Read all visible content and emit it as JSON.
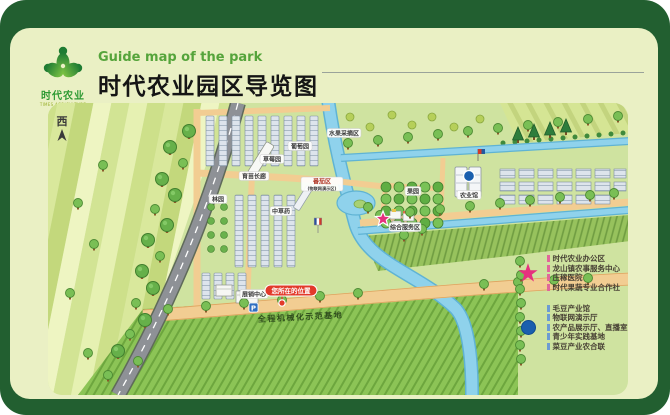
{
  "header": {
    "logo": {
      "name": "时代农业",
      "sub": "TIMES AGRICULTURE"
    },
    "subtitle_en": "Guide map of the park",
    "title": "时代农业园区导览图"
  },
  "compass": "西",
  "map": {
    "labels": {
      "grape": "葡萄园",
      "strawberry": "草莓园",
      "nursery": "育苗长廊",
      "grove": "林园",
      "herbs": "中草药",
      "tomato_line1": "番茄区",
      "tomato_line2": "(物联网演示区)",
      "fruit_picking": "水果采摘区",
      "orchard": "果园",
      "agri_hall": "农业馆",
      "service": "综合服务区",
      "exhibition": "展销中心",
      "parking": "P"
    },
    "you_are_here": "您所在的位置",
    "road_text": "全程机械化示范基地"
  },
  "legend": {
    "star_items": [
      "时代农业办公区",
      "龙山镇农事服务中心",
      "庄稼医院",
      "时代果蔬专业合作社"
    ],
    "dot_items": [
      "毛豆产业馆",
      "物联网演示厅",
      "农产品展示厅、直播室",
      "青少年实践基地",
      "菜豆产业农合联"
    ]
  },
  "colors": {
    "frame_green": "#225f30",
    "card_bg": "#eaf0c4",
    "map_bg": "#cfe3a0",
    "accent_green": "#55a43b",
    "star_pink": "#e5317e",
    "dot_blue": "#1a5fae",
    "here_red": "#e23a2a"
  }
}
